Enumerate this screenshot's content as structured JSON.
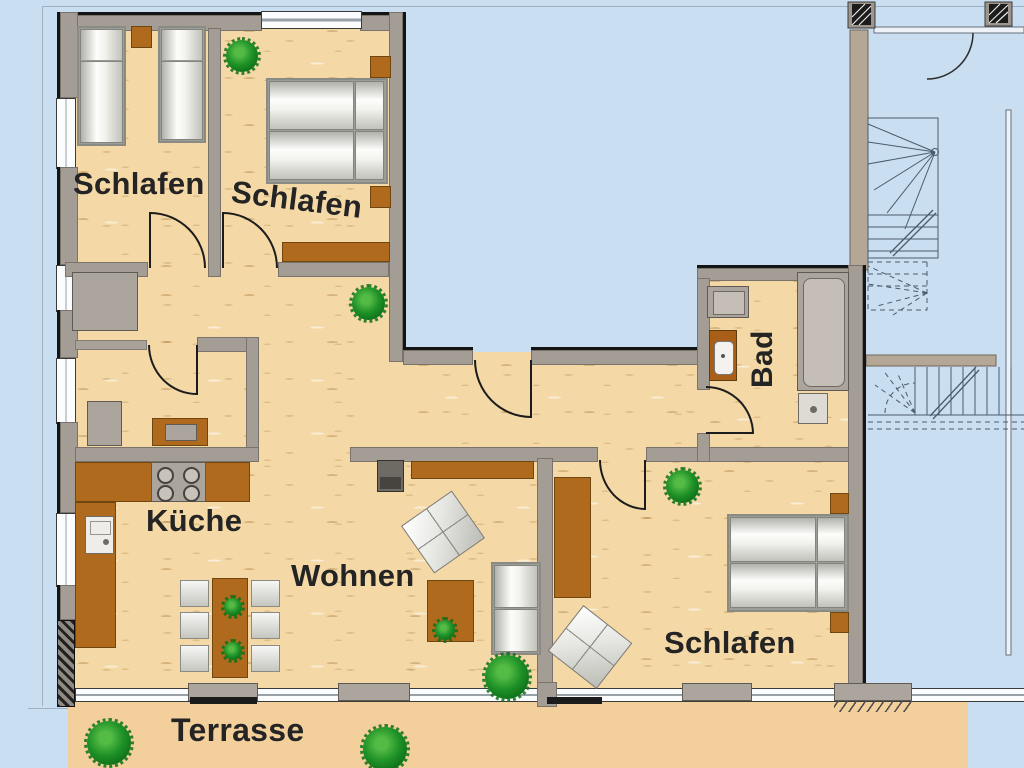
{
  "title": "Wohnung Grundriss",
  "rooms": {
    "bedroom1": {
      "label": "Schlafen"
    },
    "bedroom2": {
      "label": "Schlafen"
    },
    "bedroom3": {
      "label": "Schlafen"
    },
    "kitchen": {
      "label": "Küche"
    },
    "living": {
      "label": "Wohnen"
    },
    "bath": {
      "label": "Bad"
    },
    "terrace": {
      "label": "Terrasse"
    }
  },
  "colors": {
    "outside_blue": "#c9def0",
    "floor_wood": "#f4d8a6",
    "terrace_tan": "#f2cf9b",
    "wall_gray": "#a39d95",
    "furniture_brown": "#b06a1e",
    "plant_green": "#1e9127"
  }
}
